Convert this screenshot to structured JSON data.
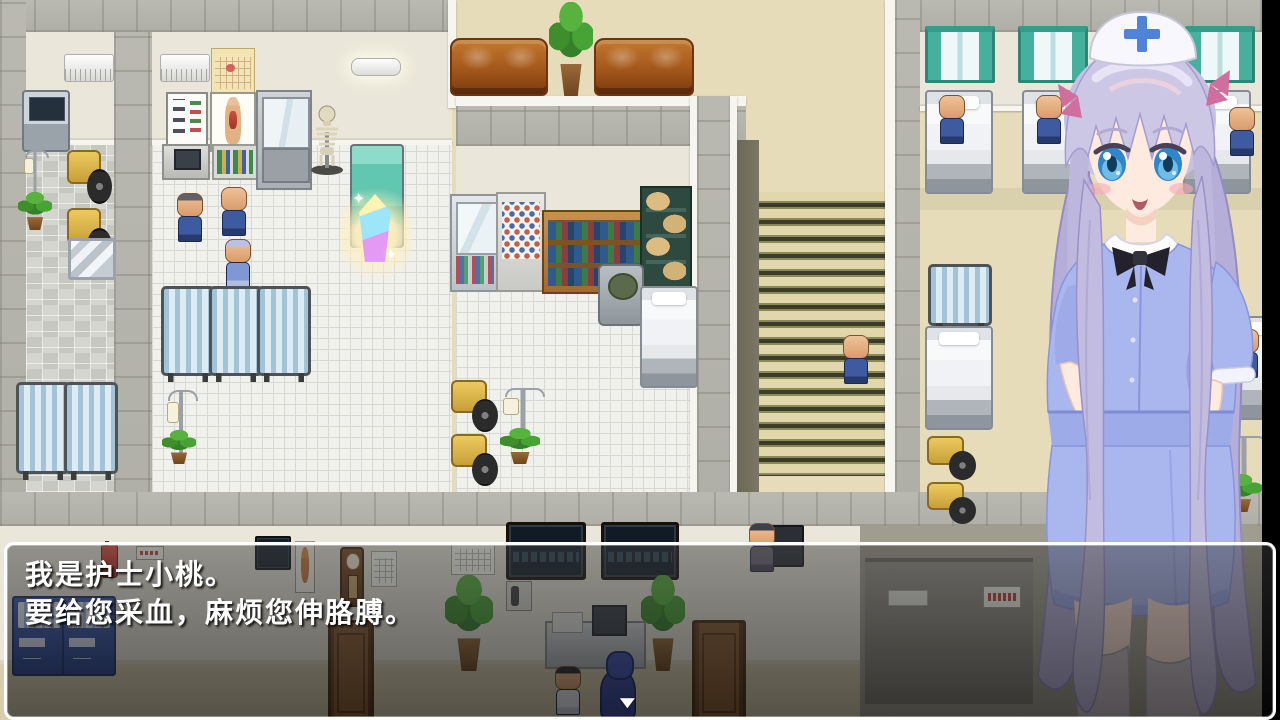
{
  "game": {
    "dialogue": {
      "lines": [
        "我是护士小桃。",
        "要给您采血，麻烦您伸胳膊。"
      ],
      "continue_indicator": "▼"
    },
    "icons": {
      "sparkle": "✦"
    },
    "colors": {
      "dialog_border": "#ffffff",
      "dialog_background": "rgba(20,20,20,0.55)",
      "nurse_dress": "#aab6ee",
      "nurse_hair": "#c6c0e2",
      "curtain_teal": "#45b09c",
      "floor_beige": "#e7dcba",
      "crystal_glow": "#ffecaa",
      "stairs_stripe": "#3e3e2c"
    }
  }
}
